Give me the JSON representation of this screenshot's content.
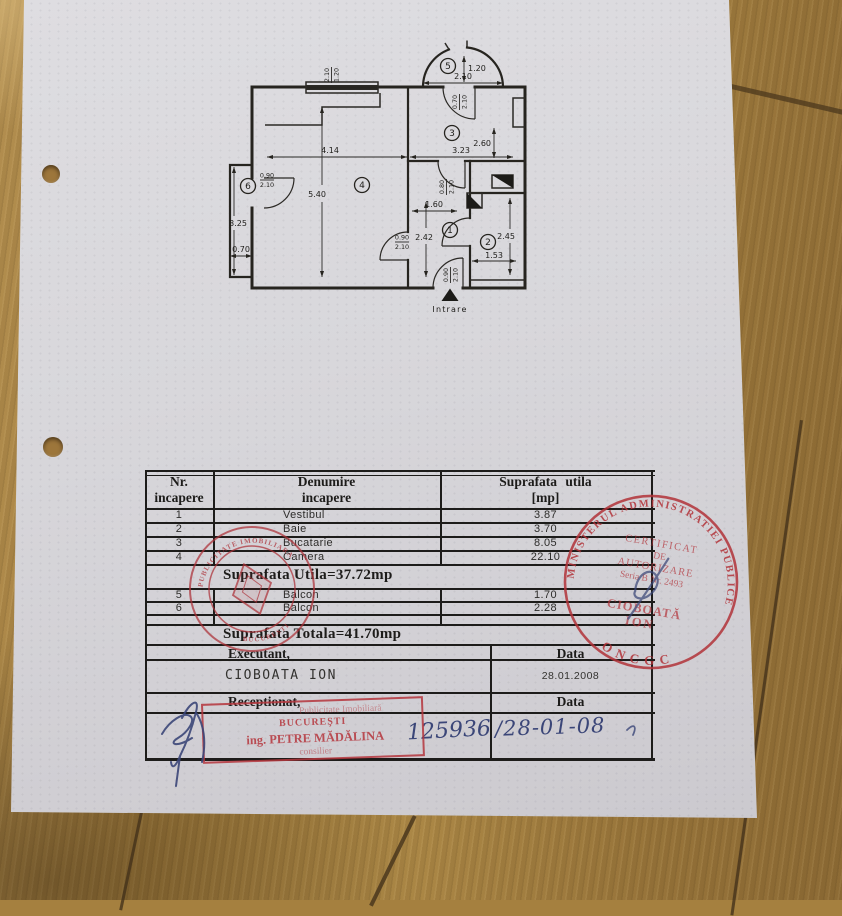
{
  "floor_plan": {
    "room_numbers": [
      "1",
      "2",
      "3",
      "4",
      "5",
      "6"
    ],
    "entrance_label": "Intrare",
    "dimensions": {
      "d414": "4.14",
      "d540": "5.40",
      "d323": "3.23",
      "d260": "2.60",
      "d160": "1.60",
      "d242": "2.42",
      "d245": "2.45",
      "d153": "1.53",
      "d325": "3.25",
      "d070": "0.70",
      "d120": "1.20",
      "d210": "2.10"
    },
    "door_labels": {
      "f090": "0.90",
      "f210": "2.10",
      "f080": "0.80",
      "f070": "0.70",
      "win_top": "2.10",
      "win_bot": "1.20"
    }
  },
  "table": {
    "header": {
      "col1a": "Nr.",
      "col1b": "incapere",
      "col2a": "Denumire",
      "col2b": "incapere",
      "col3a": "Suprafata  utila",
      "col3b": "[mp]"
    },
    "rows": [
      {
        "nr": "1",
        "name": "Vestibul",
        "area": "3.87"
      },
      {
        "nr": "2",
        "name": "Baie",
        "area": "3.70"
      },
      {
        "nr": "3",
        "name": "Bucatarie",
        "area": "8.05"
      },
      {
        "nr": "4",
        "name": "Camera",
        "area": "22.10"
      }
    ],
    "utila_line": "Suprafata  Utila=37.72mp",
    "balcony_rows": [
      {
        "nr": "5",
        "name": "Balcon",
        "area": "1.70"
      },
      {
        "nr": "6",
        "name": "Balcon",
        "area": "2.28"
      }
    ],
    "totala_line": "Suprafata  Totala=41.70mp",
    "executant_label": "Executant,",
    "data_label_1": "Data",
    "executant_name": "CIOBOATA ION",
    "date_value": "28.01.2008",
    "receptionat_label": "Receptionat,",
    "data_label_2": "Data",
    "handwritten_number": "125936",
    "handwritten_date": "/28-01-08"
  },
  "stamps": {
    "round_right": {
      "ring_top": "MINISTERUL ADMINISTRATIEI PUBLICE",
      "ring_bottom": "ONCGC",
      "cert1": "CERTIFICAT",
      "cert2": "DE",
      "cert3": "AUTORIZARE",
      "serial": "Seria B Nr. 2493",
      "name1": "CIOBOATĂ",
      "name2": "ION"
    },
    "round_left": {
      "ring_top": "PUBLICITATE IMOBILIARA",
      "ring_bottom": "BUCURESTI"
    },
    "rect_stamp": {
      "line1": "Publicitate Imobiliară",
      "line2": "BUCUREŞTI",
      "line3": "ing. PETRE MĂDĂLINA",
      "line4": "consilier"
    }
  },
  "colors": {
    "stamp_red": "#b23339",
    "ink_blue": "#3b4678",
    "paper": "#d6d5d9",
    "wood": "#a5803f"
  }
}
